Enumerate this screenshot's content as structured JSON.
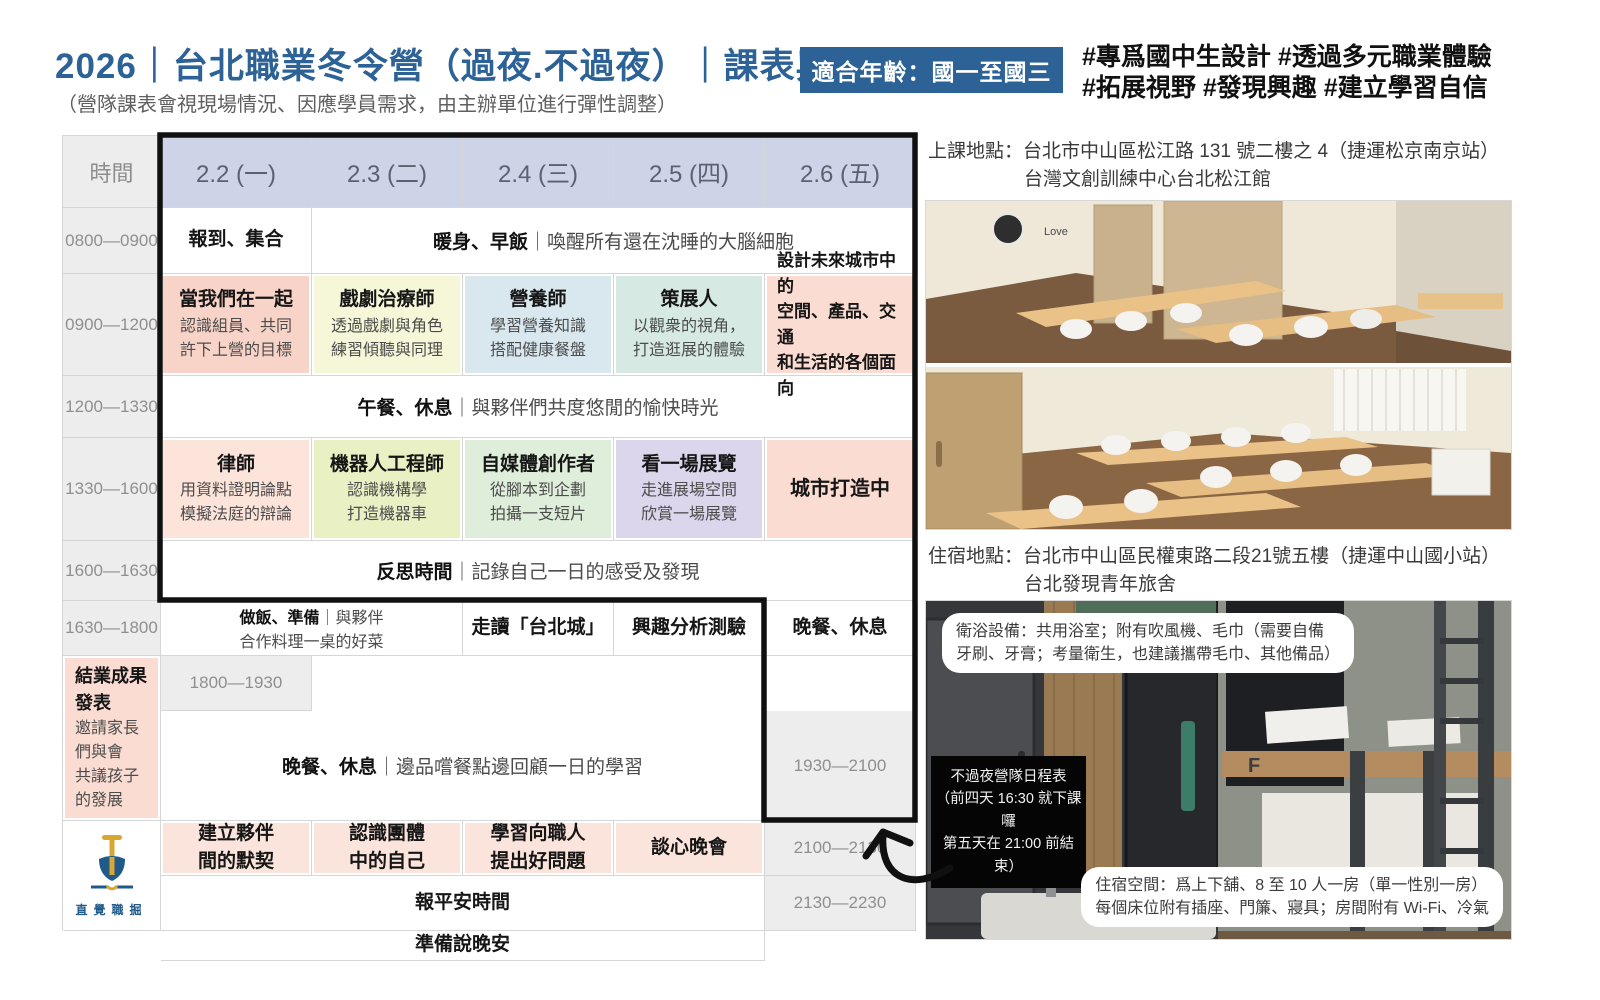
{
  "page": {
    "title": "2026｜台北職業冬令營（過夜.不過夜）｜課表與資訊",
    "subtitle": "（營隊課表會視現場情況、因應學員需求，由主辦單位進行彈性調整）",
    "age_badge": "適合年齡：國一至國三",
    "hashtag_line1": "#專爲國中生設計 #透過多元職業體驗",
    "hashtag_line2": "#拓展視野 #發現興趣 #建立學習自信"
  },
  "colors": {
    "brand_blue": "#2c6296",
    "header_row": "#cdd4e8",
    "time_col": "#ededed",
    "salmon": "#f8d4c8",
    "pale_yellow": "#f6f6d8",
    "pale_blue": "#d9e7ef",
    "pale_teal": "#d6e9e3",
    "salmon_light": "#fadcd2",
    "pink_light": "#fce4db",
    "yellow_green": "#e9f0c3",
    "pale_green": "#dfeeda",
    "pale_purple": "#dbd6eb",
    "pink_row": "#fbe4db",
    "logo_gold": "#d9a72f",
    "logo_blue": "#1f5a8a"
  },
  "schedule": {
    "time_header": "時間",
    "days": [
      "2.2 (一)",
      "2.3 (二)",
      "2.4 (三)",
      "2.5 (四)",
      "2.6 (五)"
    ],
    "rows": {
      "r1": {
        "time": "0800—0900",
        "cell1": "報到、集合",
        "span_title": "暖身、早飯",
        "span_desc": "｜喚醒所有還在沈睡的大腦細胞"
      },
      "r2": {
        "time": "0900—1200",
        "cells": [
          {
            "t": "當我們在一起",
            "d1": "認識組員、共同",
            "d2": "許下上營的目標"
          },
          {
            "t": "戲劇治療師",
            "d1": "透過戲劇與角色",
            "d2": "練習傾聽與同理"
          },
          {
            "t": "營養師",
            "d1": "學習營養知識",
            "d2": "搭配健康餐盤"
          },
          {
            "t": "策展人",
            "d1": "以觀衆的視角，",
            "d2": "打造逛展的體驗"
          },
          {
            "t1": "設計未來城市中的",
            "t2": "空間、產品、交通",
            "t3": "和生活的各個面向"
          }
        ]
      },
      "r3": {
        "time": "1200—1330",
        "span_title": "午餐、休息",
        "span_desc": "｜與夥伴們共度悠閒的愉快時光"
      },
      "r4": {
        "time": "1330—1600",
        "cells": [
          {
            "t": "律師",
            "d1": "用資料證明論點",
            "d2": "模擬法庭的辯論"
          },
          {
            "t": "機器人工程師",
            "d1": "認識機構學",
            "d2": "打造機器車"
          },
          {
            "t": "自媒體創作者",
            "d1": "從腳本到企劃",
            "d2": "拍攝一支短片"
          },
          {
            "t": "看一場展覽",
            "d1": "走進展場空間",
            "d2": "欣賞一場展覽"
          },
          {
            "t": "城市打造中"
          }
        ]
      },
      "r5": {
        "time": "1600—1630",
        "span_title": "反思時間",
        "span_desc": "｜記錄自己一日的感受及發現"
      },
      "r6": {
        "time": "1630—1800",
        "cook_title": "做飯、準備",
        "cook_rest": "｜與夥伴",
        "cook_line2": "合作料理一桌的好菜",
        "c3": "走讀「台北城」",
        "c4": "興趣分析測驗",
        "c5": "晚餐、休息"
      },
      "r7": {
        "time": "1800—1930",
        "span_title": "晚餐、休息",
        "span_desc": "｜邊品嚐餐點邊回顧一日的學習",
        "c5_title": "結業成果發表",
        "c5_d1": "邀請家長們與會",
        "c5_d2": "共議孩子的發展"
      },
      "r8": {
        "time": "1930—2100",
        "cells": [
          {
            "l1": "建立夥伴",
            "l2": "間的默契"
          },
          {
            "l1": "認識團體",
            "l2": "中的自己"
          },
          {
            "l1": "學習向職人",
            "l2": "提出好問題"
          },
          {
            "l1": "談心晚會",
            "l2": ""
          }
        ]
      },
      "r9": {
        "time": "2100—2130",
        "span_title": "報平安時間"
      },
      "r10": {
        "time": "2130—2230",
        "span_title": "準備說晚安"
      }
    }
  },
  "locations": {
    "class_line1": "上課地點：台北市中山區松江路 131 號二樓之 4（捷運松京南京站）",
    "class_line2": "台灣文創訓練中心台北松江館",
    "stay_line1": "住宿地點：台北市中山區民權東路二段21號五樓（捷運中山國小站）",
    "stay_line2": "台北發現青年旅舍"
  },
  "overlays": {
    "bath_line1": "衛浴設備：共用浴室；附有吹風機、毛巾（需要自備",
    "bath_line2": "牙刷、牙膏；考量衛生，也建議攜帶毛巾、其他備品）",
    "day_camp_line1": "不過夜營隊日程表",
    "day_camp_line2": "（前四天 16:30 就下課囉",
    "day_camp_line3": "第五天在 21:00 前結束）",
    "room_line1": "住宿空間：爲上下舖、8 至 10 人一房（單一性別一房）",
    "room_line2": "每個床位附有插座、門簾、寢具；房間附有 Wi-Fi、冷氣",
    "photo_decal": "Love"
  },
  "logo": {
    "wordmark": "直覺職掘"
  }
}
